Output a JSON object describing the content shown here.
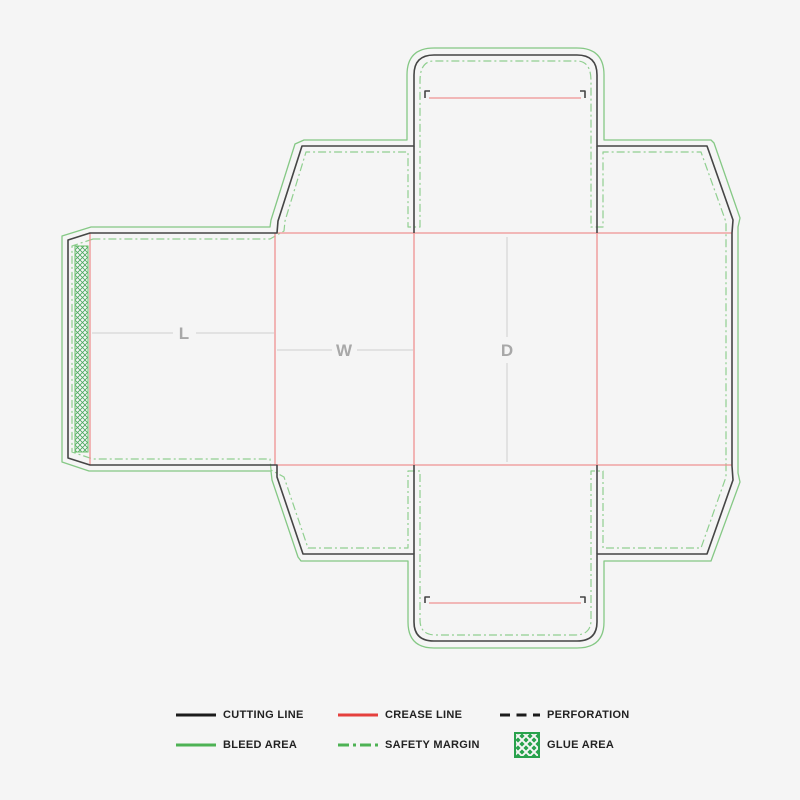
{
  "colors": {
    "bg": "#f5f5f5",
    "cut": "#454545",
    "crease": "#ef9292",
    "bleed": "#85c885",
    "safety": "#90cf90",
    "glue_hatch": "#4aa85e",
    "glue_border": "#6abf6a",
    "dim_line": "#d6d6d6",
    "dim_text": "#a8a8a8",
    "legend_cut": "#1b1b1b",
    "legend_crease": "#e5403d",
    "legend_green": "#4db254",
    "legend_glue": "#28a24c",
    "legend_text": "#222222"
  },
  "dieline": {
    "labels": {
      "length": "L",
      "width": "W",
      "depth": "D"
    }
  },
  "legend": {
    "items": [
      {
        "id": "cutting-line",
        "label": "CUTTING LINE"
      },
      {
        "id": "crease-line",
        "label": "CREASE LINE"
      },
      {
        "id": "perforation",
        "label": "PERFORATION"
      },
      {
        "id": "bleed-area",
        "label": "BLEED AREA"
      },
      {
        "id": "safety-margin",
        "label": "SAFETY MARGIN"
      },
      {
        "id": "glue-area",
        "label": "GLUE AREA"
      }
    ]
  }
}
